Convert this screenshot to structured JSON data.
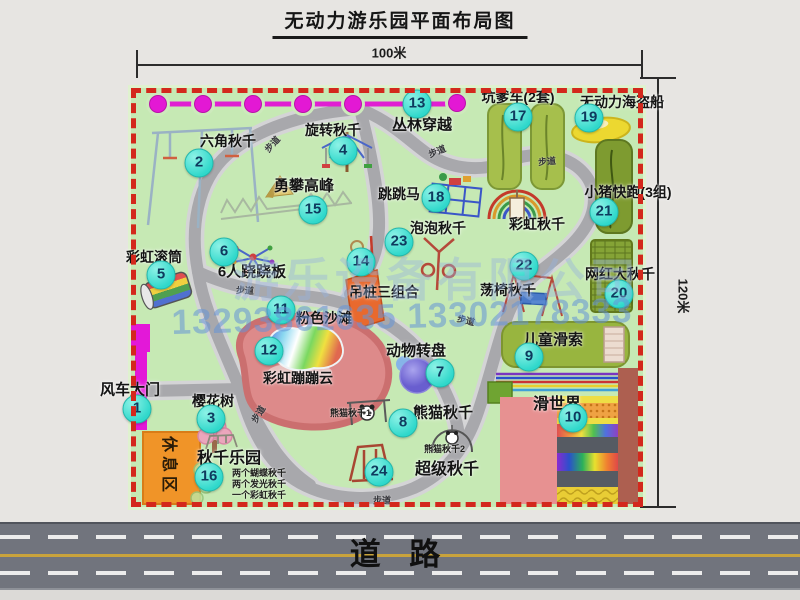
{
  "title": "无动力游乐园平面布局图",
  "dimensions": {
    "width": "100米",
    "height": "120米"
  },
  "watermark": {
    "company": "游乐设备有限公司",
    "phone": "13293861635 13302178333"
  },
  "road_label": "道 路",
  "path_label": "步道",
  "rest_area_label": "休息区",
  "rainbow_swing_label": "彩虹秋千",
  "attractions": [
    {
      "num": "1",
      "label": "风车大门"
    },
    {
      "num": "2",
      "label": "六角秋千"
    },
    {
      "num": "3",
      "label": "樱花树"
    },
    {
      "num": "4",
      "label": "旋转秋千"
    },
    {
      "num": "5",
      "label": "彩虹滚筒"
    },
    {
      "num": "6",
      "label": "6人跷跷板"
    },
    {
      "num": "7",
      "label": "动物转盘"
    },
    {
      "num": "8",
      "label": "熊猫秋千"
    },
    {
      "num": "9",
      "label": "儿童滑索"
    },
    {
      "num": "10",
      "label": "滑世界"
    },
    {
      "num": "11",
      "label": "粉色沙滩"
    },
    {
      "num": "12",
      "label": "彩虹蹦蹦云"
    },
    {
      "num": "13",
      "label": "丛林穿越"
    },
    {
      "num": "14",
      "label": "吊桩三组合"
    },
    {
      "num": "15",
      "label": "勇攀高峰"
    },
    {
      "num": "16",
      "label": "秋千乐园",
      "notes": [
        "两个蝴蝶秋千",
        "两个发光秋千",
        "一个彩虹秋千"
      ]
    },
    {
      "num": "17",
      "label": "坑爹车(2套)"
    },
    {
      "num": "18",
      "label": "跳跳马"
    },
    {
      "num": "19",
      "label": "无动力海盗船"
    },
    {
      "num": "20",
      "label": "网红大秋千"
    },
    {
      "num": "21",
      "label": "小猪快跑(3组)"
    },
    {
      "num": "22",
      "label": "荡椅秋千"
    },
    {
      "num": "23",
      "label": "泡泡秋千"
    },
    {
      "num": "24",
      "label": "超级秋千"
    }
  ],
  "panda_swing_notes": [
    "熊猫秋千1",
    "熊猫秋千2"
  ],
  "colors": {
    "map_green": "#c6e9b4",
    "border_red": "#d3281c",
    "marker_cyan": "#3adfd3",
    "accent_magenta": "#e318d4",
    "watermark_blue": "#6e96d7"
  }
}
